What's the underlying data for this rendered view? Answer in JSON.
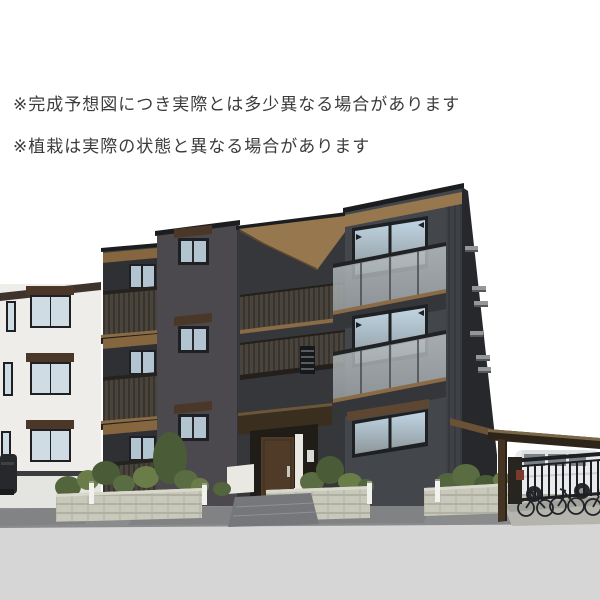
{
  "disclaimers": {
    "line1": "※完成予想図につき実際とは多少異なる場合があります",
    "line2": "※植栽は実際の状態と異なる場合があります"
  },
  "palette": {
    "sky": "#ffffff",
    "textColor": "#3b3b3b",
    "facade": "#3f4146",
    "facade2": "#43464b",
    "facadeTower": "#4b494d",
    "facadeBay": "#35373a",
    "facadeSide": "#27282b",
    "soffit": "#97774e",
    "soffitDark": "#85663f",
    "awning": "#4a3727",
    "coping": "#1c1d1f",
    "door": "#4f3b28",
    "whiteHouse": "#eeedea",
    "whiteHouseBase": "#e4e4e0",
    "whRoof": "#3e342c",
    "frame": "#1e2023",
    "glassLight": "#b2c4d0",
    "whGlass": "#cfdce4",
    "road": "#8a8b8c",
    "roadLight": "#d6d6d6",
    "steps": "#75777a",
    "bollard": "#f1f1ed",
    "carportRoof": "#2e251a",
    "carportPost": "#453323",
    "carBody": "#e9eaeb",
    "darkMetal": "#1d1f22",
    "vent": "#94979a",
    "tanEdge": "#8a6b46",
    "bush1": "#4a5c37",
    "bush2": "#5a6d42",
    "bush3": "#6a7d49",
    "bush4": "#52653d",
    "apron": "#b5b5ae",
    "canopy": "#3a2e1f"
  }
}
